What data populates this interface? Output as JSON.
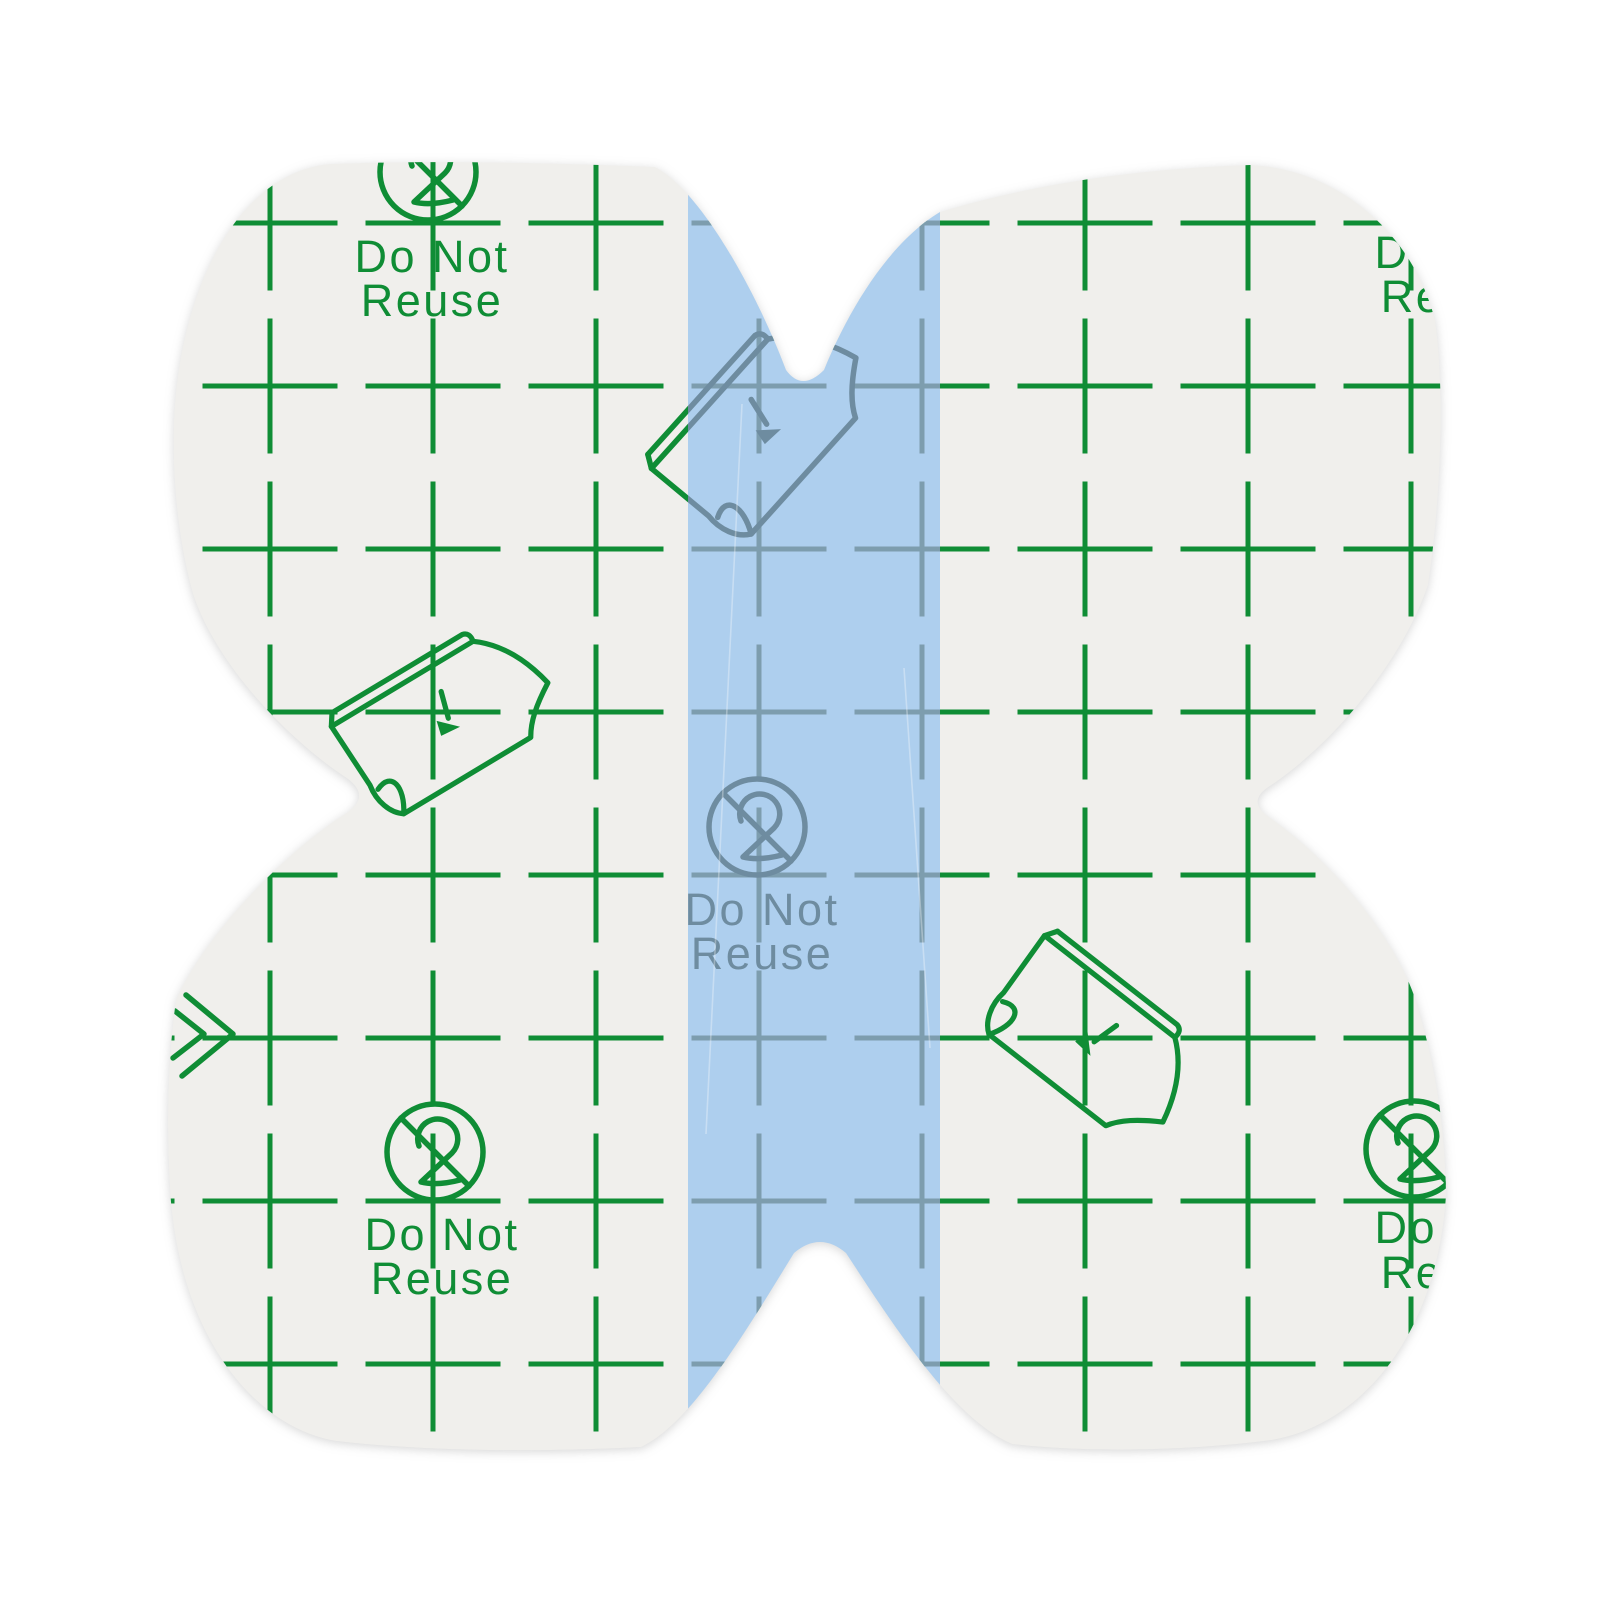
{
  "image": {
    "kind": "product-photo",
    "subject": "Butterfly-shaped adhesive film dressing with printed release liner and center pull tab"
  },
  "labels": {
    "do_not": "Do Not",
    "reuse": "Reuse"
  },
  "colors": {
    "page_bg": "#ffffff",
    "liner_paper": "#f0efec",
    "print_green": "#0f8d35",
    "pull_tab_blue": "#aecfee",
    "print_slate": "#6e8ca0",
    "grid_slate": "#7d9dae"
  },
  "liner_print": {
    "grid_spacing_px": 163,
    "motifs": [
      "square-grid",
      "no-reuse-symbol",
      "do-not-reuse-text",
      "peel-liner-icon"
    ],
    "text_blocks": [
      {
        "position": "top-left",
        "ink": "green",
        "clipped_by_edge": false
      },
      {
        "position": "top-right",
        "ink": "green",
        "clipped_by_edge": true
      },
      {
        "position": "center-pull-tab",
        "ink": "slate",
        "clipped_by_edge": false
      },
      {
        "position": "bottom-left",
        "ink": "green",
        "clipped_by_edge": false
      },
      {
        "position": "bottom-right",
        "ink": "green",
        "clipped_by_edge": true
      }
    ],
    "peel_icons": [
      {
        "position": "left-middle",
        "ink": "green"
      },
      {
        "position": "top-center-on-tab",
        "ink": "slate-and-green"
      },
      {
        "position": "bottom-right-middle",
        "ink": "green"
      },
      {
        "position": "left-notch-edge-partial",
        "ink": "green"
      }
    ]
  }
}
